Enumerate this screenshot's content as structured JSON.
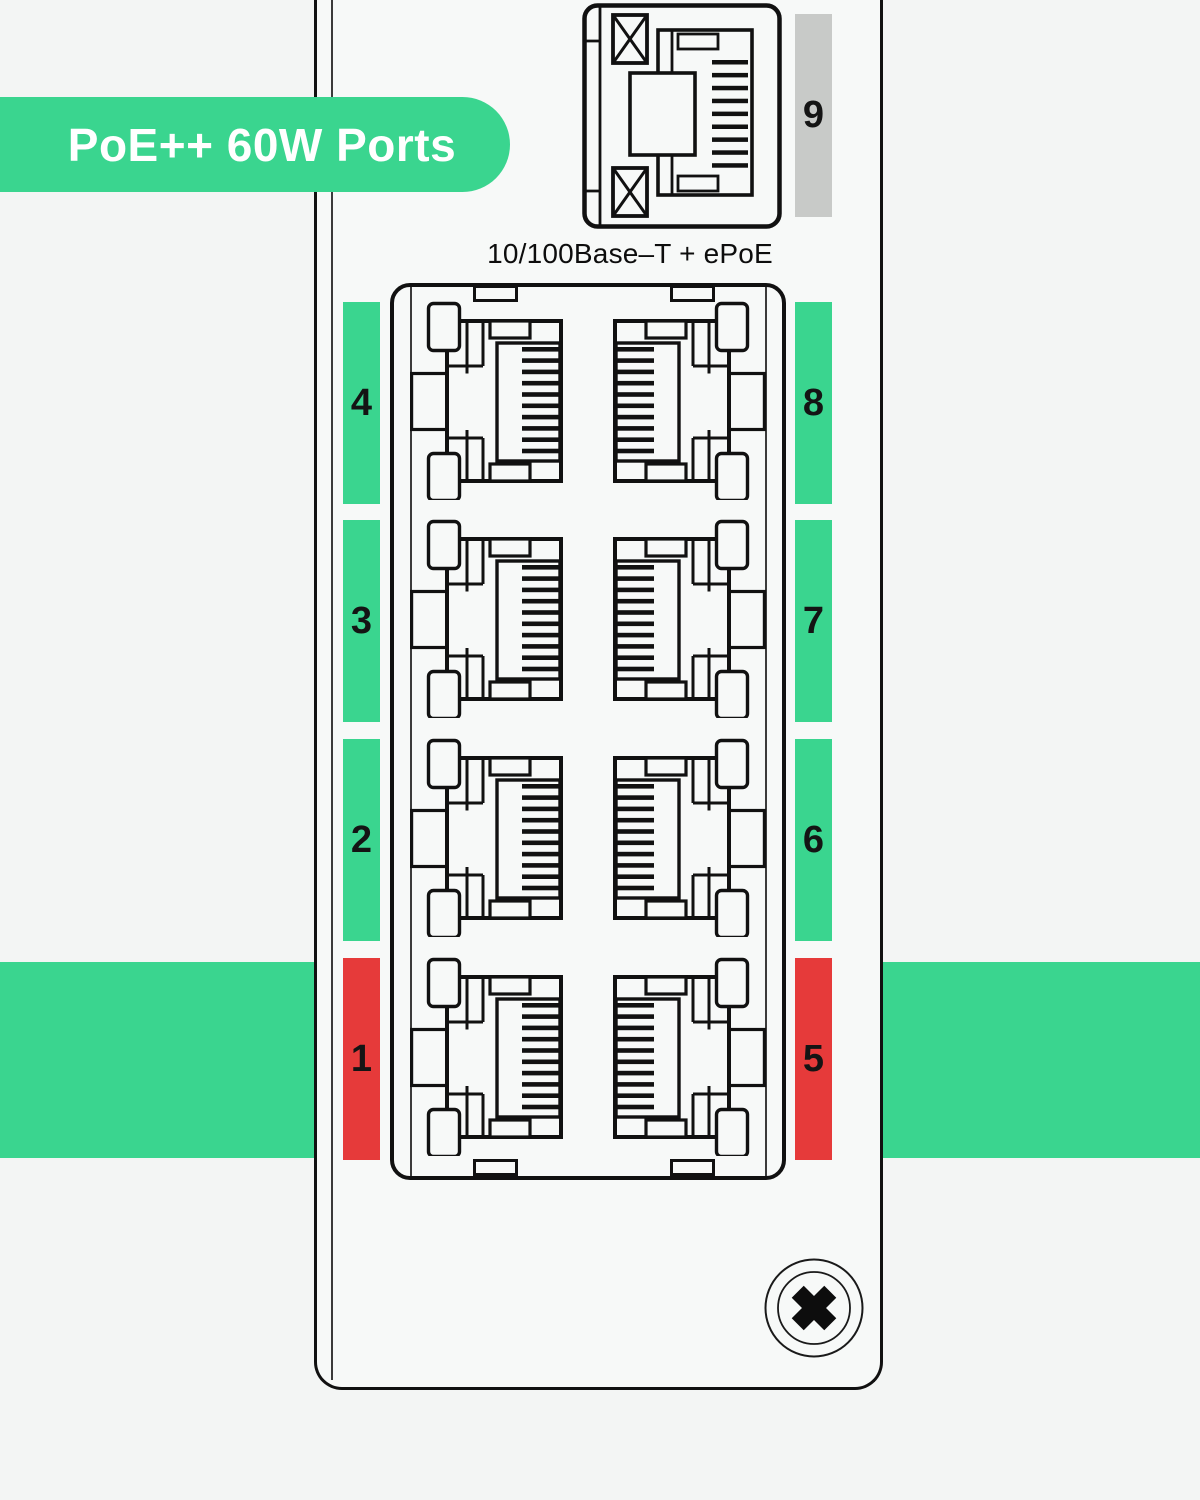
{
  "badge": {
    "label": "PoE++ 60W Ports"
  },
  "caption": "10/100Base–T + ePoE",
  "ports": {
    "left": [
      {
        "number": "4",
        "color": "#3ad58f"
      },
      {
        "number": "3",
        "color": "#3ad58f"
      },
      {
        "number": "2",
        "color": "#3ad58f"
      },
      {
        "number": "1",
        "color": "#e63a3a"
      }
    ],
    "right": [
      {
        "number": "8",
        "color": "#3ad58f"
      },
      {
        "number": "7",
        "color": "#3ad58f"
      },
      {
        "number": "6",
        "color": "#3ad58f"
      },
      {
        "number": "5",
        "color": "#e63a3a"
      }
    ],
    "uplink": {
      "number": "9",
      "color": "#c8cac8"
    }
  },
  "colors": {
    "accent_green": "#3ad58f",
    "alert_red": "#e63a3a",
    "neutral_gray": "#c8cac8",
    "band_green": "#3ad58f"
  }
}
